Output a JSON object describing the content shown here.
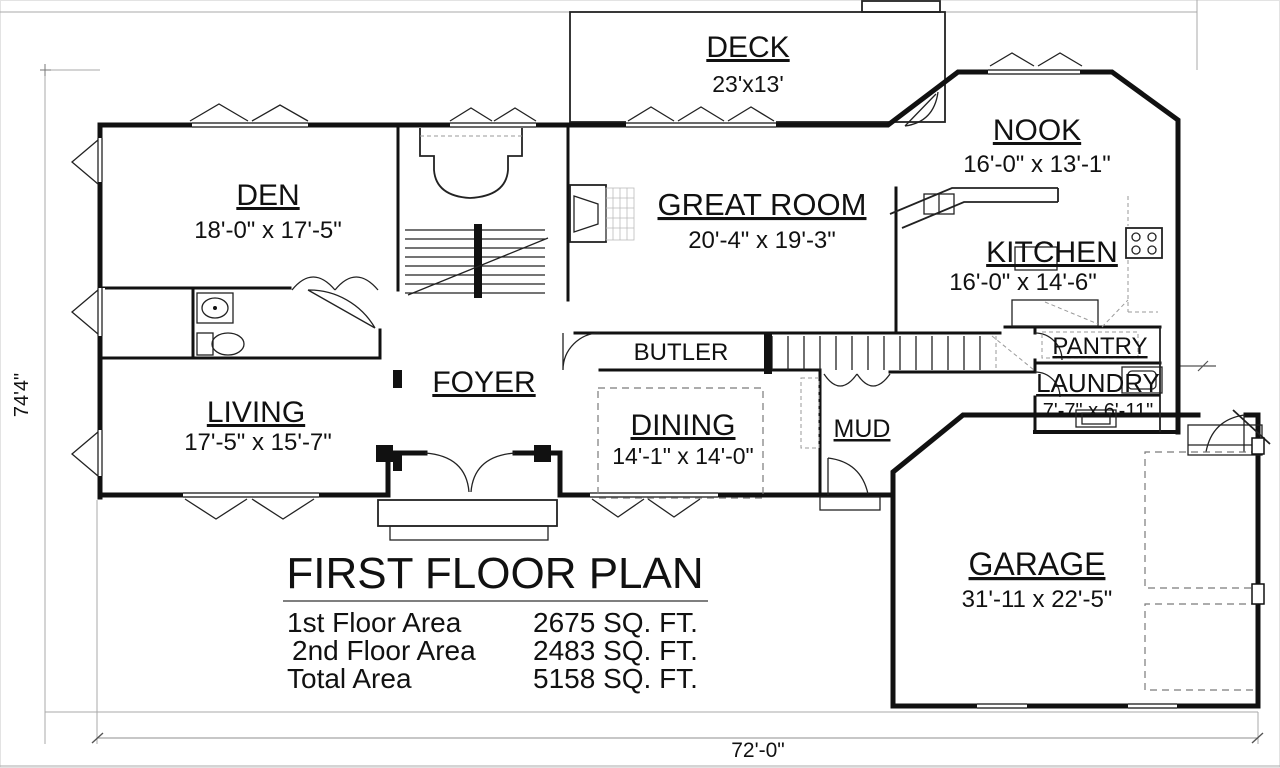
{
  "plan": {
    "title": "FIRST FLOOR PLAN",
    "rooms": {
      "deck": {
        "name": "DECK",
        "size": "23'x13'"
      },
      "nook": {
        "name": "NOOK",
        "size": "16'-0\" x 13'-1\""
      },
      "den": {
        "name": "DEN",
        "size": "18'-0\" x 17'-5\""
      },
      "great": {
        "name": "GREAT ROOM",
        "size": "20'-4\" x 19'-3\""
      },
      "kitchen": {
        "name": "KITCHEN",
        "size": "16'-0\" x 14'-6\""
      },
      "butler": {
        "name": "BUTLER"
      },
      "pantry": {
        "name": "PANTRY"
      },
      "laundry": {
        "name": "LAUNDRY",
        "size": "7'-7\" x 6'-11\""
      },
      "foyer": {
        "name": "FOYER"
      },
      "living": {
        "name": "LIVING",
        "size": "17'-5\" x 15'-7\""
      },
      "dining": {
        "name": "DINING",
        "size": "14'-1\" x 14'-0\""
      },
      "mud": {
        "name": "MUD"
      },
      "garage": {
        "name": "GARAGE",
        "size": "31'-11 x 22'-5\""
      }
    },
    "area_table": {
      "rows": [
        {
          "label": "1st Floor Area",
          "value": "2675 SQ. FT."
        },
        {
          "label": "2nd Floor Area",
          "value": "2483 SQ. FT."
        },
        {
          "label": "Total Area",
          "value": "5158 SQ. FT."
        }
      ]
    },
    "dimensions": {
      "bottom": "72'-0\"",
      "left": "74'4\""
    },
    "colors": {
      "line": "#111111",
      "dim_line": "#a8a8a8",
      "background": "#ffffff"
    }
  }
}
